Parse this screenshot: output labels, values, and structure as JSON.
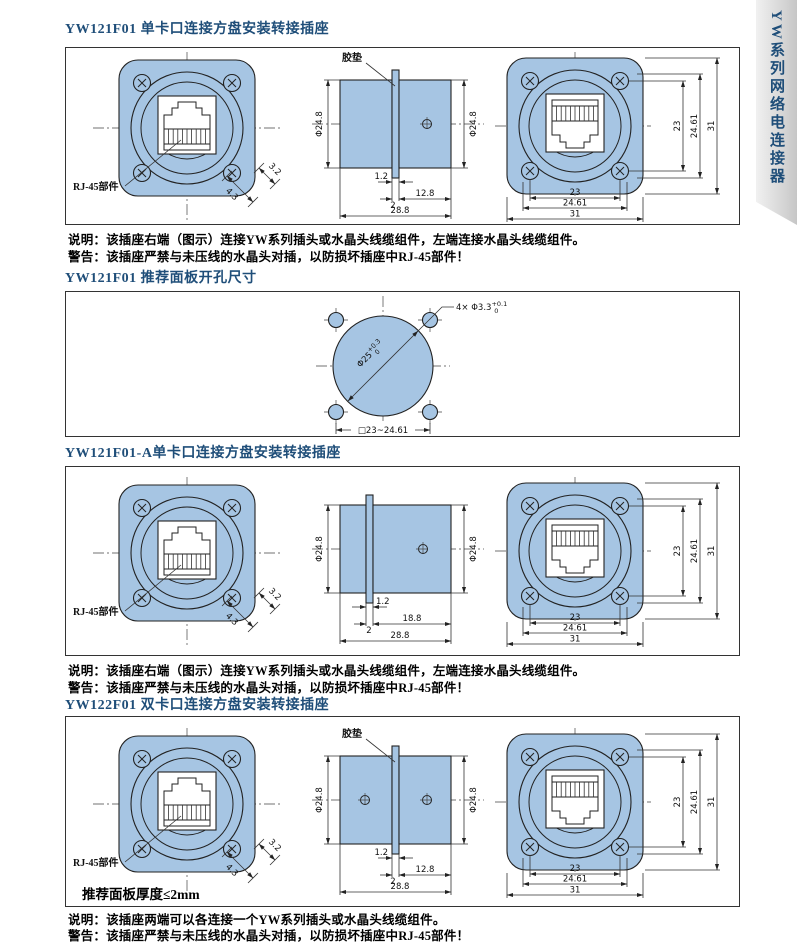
{
  "sidebar": {
    "tab_label": "YW系列网络电连接器"
  },
  "colors": {
    "fill_blue": "#a6c5e3",
    "line": "#222222",
    "title": "#1f4e79"
  },
  "sections": {
    "s1": {
      "title": "YW121F01 单卡口连接方盘安装转接插座",
      "note": "说明：该插座右端（图示）连接YW系列插头或水晶头线缆组件，左端连接水晶头线缆组件。",
      "warning": "警告：该插座严禁与未压线的水晶头对插，以防损坏插座中RJ-45部件！",
      "front": {
        "rj45_label": "RJ-45部件",
        "dim_a": "4.3",
        "dim_b": "3.2"
      },
      "side": {
        "gasket_label": "胶垫",
        "dia_left": "Φ24.8",
        "dia_right": "Φ24.8",
        "dim_gasket": "1.2",
        "dim_step": "2",
        "dim_mid": "12.8",
        "dim_total": "28.8"
      },
      "rear": {
        "v1": "23",
        "v2": "24.61",
        "v3": "31",
        "h1": "23",
        "h2": "24.61",
        "h3": "31"
      }
    },
    "s2": {
      "title": "YW121F01 推荐面板开孔尺寸",
      "holes_label": "4× Φ3.3",
      "holes_tol_sup": "+0.1",
      "holes_tol_sub": "0",
      "dia_label": "Φ25",
      "dia_tol_sup": "+0.3",
      "dia_tol_sub": "0",
      "square_dim": "□23~24.61"
    },
    "s3": {
      "title": "YW121F01-A单卡口连接方盘安装转接插座",
      "note": "说明：该插座右端（图示）连接YW系列插头或水晶头线缆组件，左端连接水晶头线缆组件。",
      "warning": "警告：该插座严禁与未压线的水晶头对插，以防损坏插座中RJ-45部件！",
      "front": {
        "rj45_label": "RJ-45部件",
        "dim_a": "4.3",
        "dim_b": "3.2"
      },
      "side": {
        "dia_left": "Φ24.8",
        "dia_right": "Φ24.8",
        "dim_gasket": "1.2",
        "dim_step": "2",
        "dim_mid": "18.8",
        "dim_total": "28.8"
      },
      "rear": {
        "v1": "23",
        "v2": "24.61",
        "v3": "31",
        "h1": "23",
        "h2": "24.61",
        "h3": "31"
      }
    },
    "s4": {
      "title": "YW122F01 双卡口连接方盘安装转接插座",
      "panel_note": "推荐面板厚度≤2mm",
      "note": "说明：该插座两端可以各连接一个YW系列插头或水晶头线缆组件。",
      "warning": "警告：该插座严禁与未压线的水晶头对插，以防损坏插座中RJ-45部件！",
      "front": {
        "rj45_label": "RJ-45部件",
        "dim_a": "4.3",
        "dim_b": "3.2"
      },
      "side": {
        "gasket_label": "胶垫",
        "dia_left": "Φ24.8",
        "dia_right": "Φ24.8",
        "dim_gasket": "1.2",
        "dim_step": "2",
        "dim_mid": "12.8",
        "dim_total": "28.8"
      },
      "rear": {
        "v1": "23",
        "v2": "24.61",
        "v3": "31",
        "h1": "23",
        "h2": "24.61",
        "h3": "31"
      }
    }
  }
}
